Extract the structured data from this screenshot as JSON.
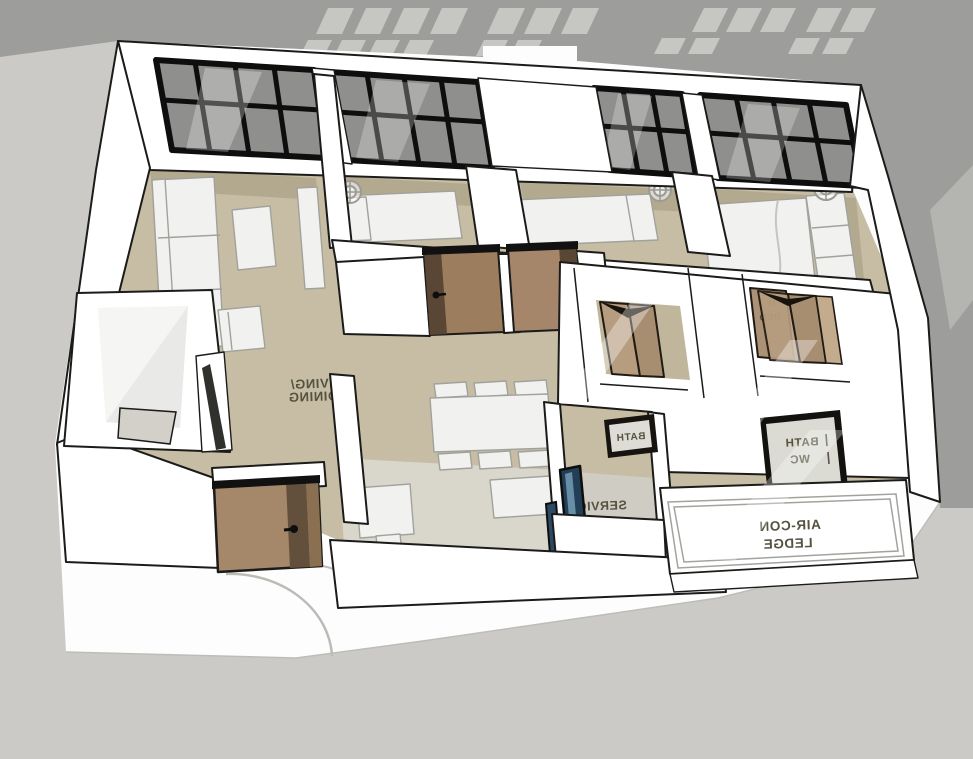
{
  "scene": {
    "description": "Mirrored 3D dollhouse-style floor plan render of an apartment",
    "view": "axonometric top-down view, all text labels appear horizontally mirrored",
    "background_upper": "#9d9d9b",
    "background_lower": "#cbcac6",
    "ground_plane": "#fdfdfd"
  },
  "palette": {
    "wall": "#ffffff",
    "outline": "#1b1b1a",
    "floor": "#c6bda4",
    "floor_shadow": "#b2a98f",
    "floor_kitchen": "#d9d6cc",
    "floor_service": "#cfccc3",
    "window_frame": "#0e0e0e",
    "window_glass": "#8f8f8d",
    "door_wood": "#a5876a",
    "door_wood_dark": "#63503c",
    "bifold_wood": "#b79d80",
    "glass_door_blue": "#223f57",
    "furniture": "#f1f1ef",
    "label_ink": "#55523f"
  },
  "labels": {
    "living_dining": {
      "line1": "LIVING/",
      "line2": "DINING"
    },
    "service_yard": {
      "line1": "SERVIC",
      "line2": "YARD"
    },
    "bath_sign": {
      "text": "BATH"
    },
    "bath_wc_sign": {
      "line1": "BATH",
      "line2": "WC"
    },
    "master_bed": {
      "line1": "M",
      "line2": "BED"
    },
    "aircon_ledge": {
      "line1": "AIR-CON",
      "line2": "LEDGE"
    }
  }
}
